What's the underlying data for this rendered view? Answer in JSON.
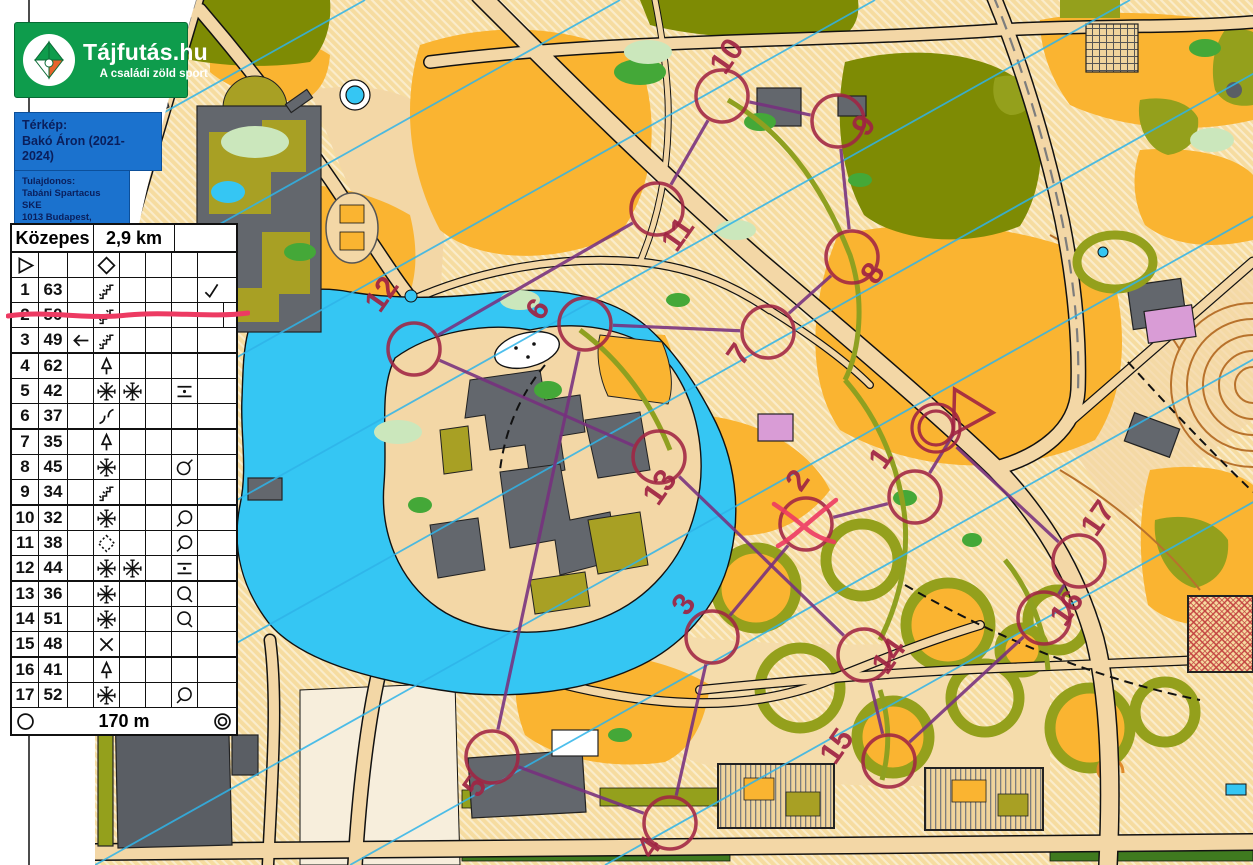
{
  "logo": {
    "title": "Tájfutás.hu",
    "subtitle": "A családi zöld sport",
    "icon": "pinwheel-compass-icon",
    "color": "#0E9C4C"
  },
  "map_credit": {
    "label": "Térkép:",
    "value": "Bakó Áron (2021-2024)"
  },
  "owner": {
    "label": "Tulajdonos:",
    "lines": [
      "Tabáni Spartacus SKE",
      "1013 Budapest,",
      "Attila út 2."
    ]
  },
  "control_card": {
    "course_name": "Közepes",
    "course_length": "2,9 km",
    "run_in": "170 m",
    "start_row": {
      "a": "start-triangle",
      "d": "diamond"
    },
    "rows": [
      {
        "no": "1",
        "code": "63",
        "sym": {
          "d": "stairway",
          "h": "check"
        },
        "voided": false
      },
      {
        "no": "2",
        "code": "50",
        "sym": {
          "d": "stairway"
        },
        "voided": true
      },
      {
        "no": "3",
        "code": "49",
        "sym": {
          "c": "arrow-left",
          "d": "stairway"
        },
        "voided": false
      },
      {
        "no": "4",
        "code": "62",
        "sym": {
          "d": "tree"
        },
        "voided": false
      },
      {
        "no": "5",
        "code": "42",
        "sym": {
          "d": "thicket",
          "e": "thicket",
          "g": "between"
        },
        "voided": false
      },
      {
        "no": "6",
        "code": "37",
        "sym": {
          "d": "bend"
        },
        "voided": false
      },
      {
        "no": "7",
        "code": "35",
        "sym": {
          "d": "tree"
        },
        "voided": false
      },
      {
        "no": "8",
        "code": "45",
        "sym": {
          "d": "thicket",
          "g": "side-ne"
        },
        "voided": false
      },
      {
        "no": "9",
        "code": "34",
        "sym": {
          "d": "stairway"
        },
        "voided": false
      },
      {
        "no": "10",
        "code": "32",
        "sym": {
          "d": "thicket",
          "g": "side-w"
        },
        "voided": false
      },
      {
        "no": "11",
        "code": "38",
        "sym": {
          "d": "open-diamond",
          "g": "side-w"
        },
        "voided": false
      },
      {
        "no": "12",
        "code": "44",
        "sym": {
          "d": "thicket",
          "e": "thicket",
          "g": "between"
        },
        "voided": false
      },
      {
        "no": "13",
        "code": "36",
        "sym": {
          "d": "thicket",
          "g": "side-se"
        },
        "voided": false
      },
      {
        "no": "14",
        "code": "51",
        "sym": {
          "d": "thicket",
          "g": "side-se"
        },
        "voided": false
      },
      {
        "no": "15",
        "code": "48",
        "sym": {
          "d": "x-cross"
        },
        "voided": false
      },
      {
        "no": "16",
        "code": "41",
        "sym": {
          "d": "tree"
        },
        "voided": false
      },
      {
        "no": "17",
        "code": "52",
        "sym": {
          "d": "thicket",
          "g": "side-sw"
        },
        "voided": false
      }
    ]
  },
  "course": {
    "start": {
      "x": 967,
      "y": 412
    },
    "finish": {
      "x": 936,
      "y": 428
    },
    "circle_radius": 26,
    "controls": [
      {
        "n": "1",
        "x": 915,
        "y": 497,
        "lx": 889,
        "ly": 464
      },
      {
        "n": "2",
        "x": 806,
        "y": 524,
        "lx": 806,
        "ly": 486,
        "voided": true
      },
      {
        "n": "3",
        "x": 712,
        "y": 637,
        "lx": 692,
        "ly": 610
      },
      {
        "n": "4",
        "x": 670,
        "y": 823,
        "lx": 657,
        "ly": 853
      },
      {
        "n": "5",
        "x": 492,
        "y": 757,
        "lx": 483,
        "ly": 792
      },
      {
        "n": "6",
        "x": 585,
        "y": 324,
        "lx": 546,
        "ly": 315
      },
      {
        "n": "7",
        "x": 768,
        "y": 332,
        "lx": 747,
        "ly": 360
      },
      {
        "n": "8",
        "x": 852,
        "y": 257,
        "lx": 881,
        "ly": 279
      },
      {
        "n": "9",
        "x": 838,
        "y": 121,
        "lx": 872,
        "ly": 131
      },
      {
        "n": "10",
        "x": 722,
        "y": 96,
        "lx": 735,
        "ly": 62
      },
      {
        "n": "11",
        "x": 657,
        "y": 209,
        "lx": 686,
        "ly": 240
      },
      {
        "n": "12",
        "x": 414,
        "y": 349,
        "lx": 390,
        "ly": 300
      },
      {
        "n": "13",
        "x": 659,
        "y": 457,
        "lx": 668,
        "ly": 493
      },
      {
        "n": "14",
        "x": 864,
        "y": 655,
        "lx": 897,
        "ly": 662
      },
      {
        "n": "15",
        "x": 889,
        "y": 761,
        "lx": 845,
        "ly": 752
      },
      {
        "n": "16",
        "x": 1044,
        "y": 618,
        "lx": 1075,
        "ly": 614
      },
      {
        "n": "17",
        "x": 1079,
        "y": 561,
        "lx": 1106,
        "ly": 524
      }
    ],
    "label_rotation_deg": -55
  },
  "map_colors": {
    "open_orange": "#FAB431",
    "rough_open_pale": "#F6DCA0",
    "paved": "#F3D7A6",
    "olive_green": "#94A01C",
    "dark_olive": "#7E8B04",
    "lake_blue": "#35C6F3",
    "building_gray": "#63676D",
    "overprint_circle": "#A02443",
    "overprint_line": "#77307F",
    "north_line_cyan": "#2FB4E9",
    "voided_red": "#ED3A62",
    "hedge_green": "#3F7C1F",
    "contour_brown": "#B8722C"
  }
}
